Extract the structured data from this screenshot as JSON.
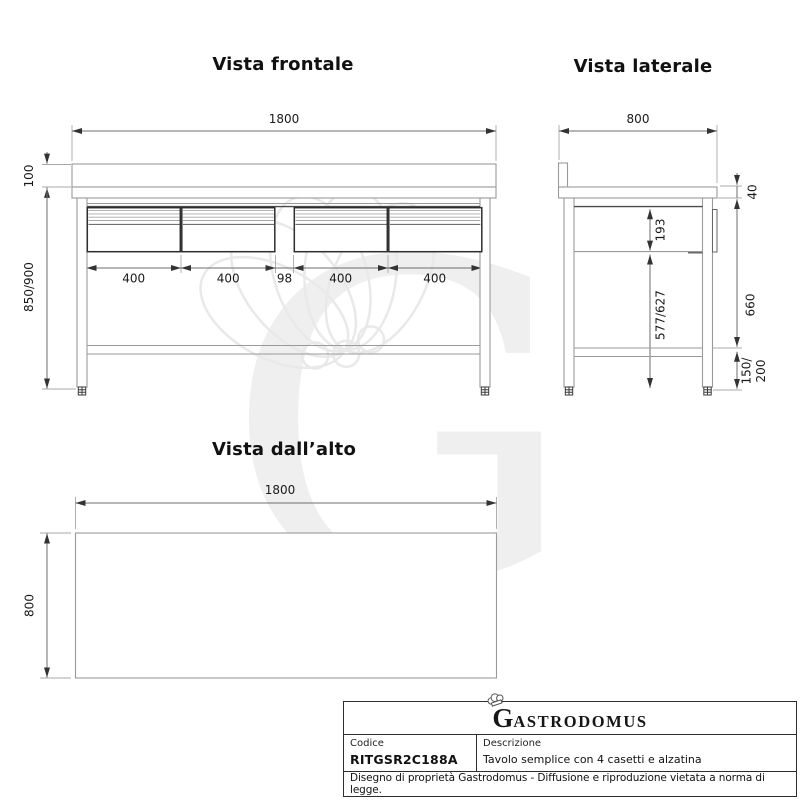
{
  "views": {
    "front": {
      "title": "Vista frontale",
      "dim_width": "1800",
      "dim_alzatina": "100",
      "dim_height": "850/900",
      "drawer_dims": [
        "400",
        "400",
        "98",
        "400",
        "400"
      ]
    },
    "side": {
      "title": "Vista laterale",
      "dim_depth": "800",
      "dim_top": "40",
      "dim_drawer_front": "193",
      "dim_underside": "660",
      "dim_leg": "577/627",
      "dim_foot_1": "150/",
      "dim_foot_2": "200"
    },
    "top": {
      "title": "Vista dall’alto",
      "dim_width": "1800",
      "dim_depth": "800"
    }
  },
  "watermark": {
    "letter": "G"
  },
  "title_block": {
    "logo_initial": "G",
    "logo_rest": "ASTRODOMUS",
    "code_label": "Codice",
    "code_value": "RITGSR2C188A",
    "desc_label": "Descrizione",
    "desc_value": "Tavolo semplice con 4 casetti e alzatina",
    "disclaimer": "Disegno di proprietà Gastrodomus - Diffusione e riproduzione vietata a norma di legge."
  },
  "colors": {
    "thin_line": "#9a9a9a",
    "dark_line": "#2e2e2e",
    "dim_line": "#6e6e6e",
    "text": "#1a1a1a",
    "watermark": "#efefef"
  }
}
